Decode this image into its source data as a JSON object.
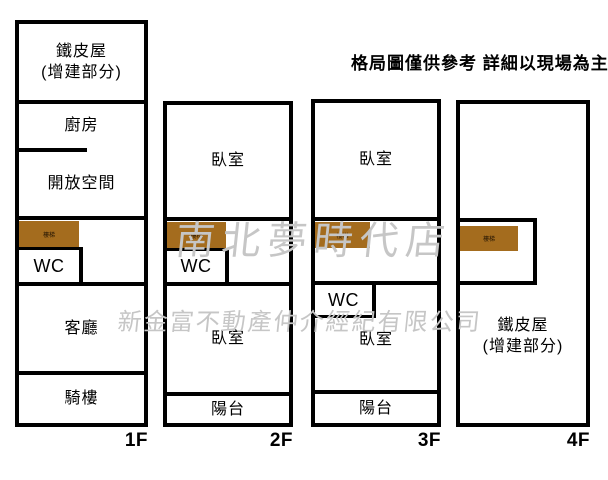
{
  "header": {
    "disclaimer": "格局圖僅供參考 詳細以現場為主"
  },
  "watermarks": {
    "store_name": "南北夢時代店",
    "company_name": "新金富不動產仲介經紀有限公司"
  },
  "colors": {
    "wall": "#000000",
    "stairs_fill": "#a46c1e",
    "watermark": "#c6c6c6"
  },
  "stairs_label": "樓梯",
  "floors": [
    {
      "label": "1F",
      "rooms": {
        "tin_house": "鐵皮屋",
        "tin_house_sub": "(增建部分)",
        "kitchen": "廚房",
        "open_space": "開放空間",
        "wc": "WC",
        "living": "客廳",
        "arcade": "騎樓"
      }
    },
    {
      "label": "2F",
      "rooms": {
        "bedroom_top": "臥室",
        "wc": "WC",
        "bedroom_bottom": "臥室",
        "balcony": "陽台"
      }
    },
    {
      "label": "3F",
      "rooms": {
        "bedroom_top": "臥室",
        "wc": "WC",
        "bedroom_bottom": "臥室",
        "balcony": "陽台"
      }
    },
    {
      "label": "4F",
      "rooms": {
        "tin_house": "鐵皮屋",
        "tin_house_sub": "(增建部分)"
      }
    }
  ]
}
